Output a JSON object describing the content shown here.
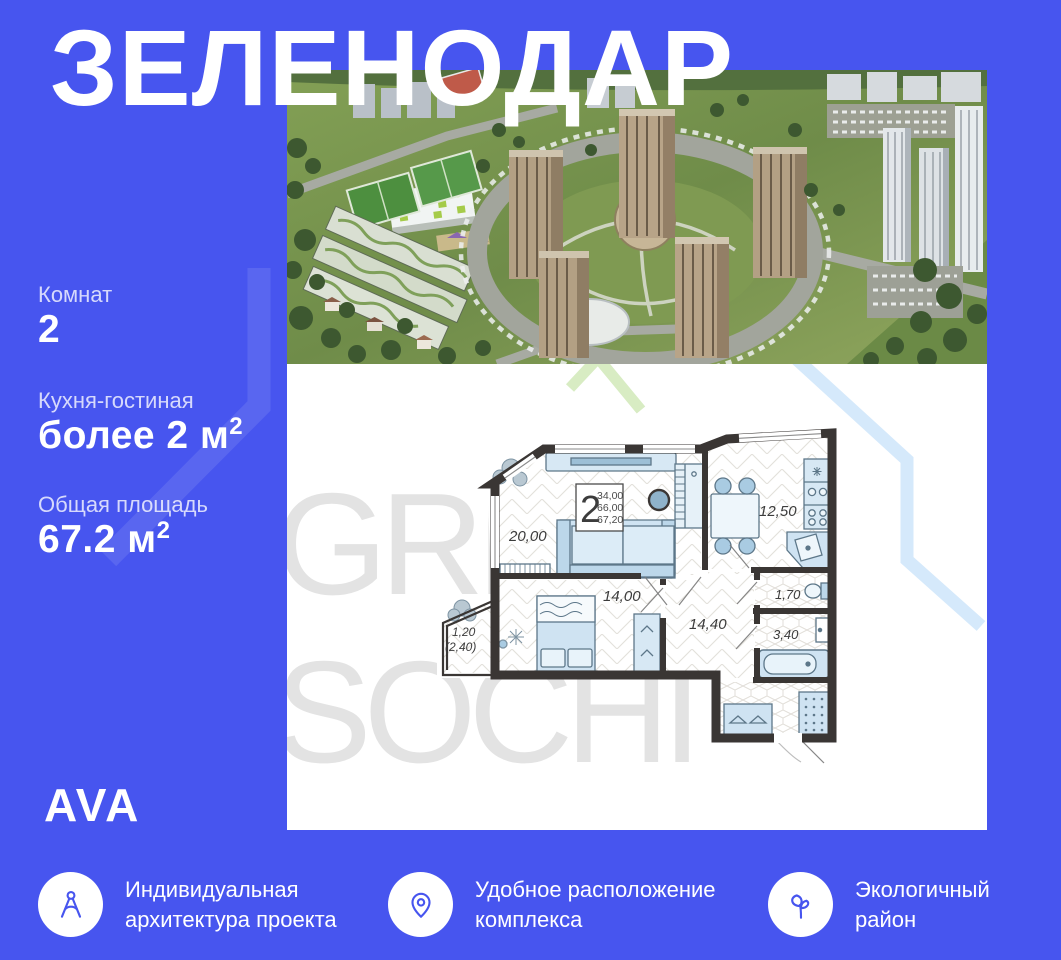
{
  "title": "ЗЕЛЕНОДАР",
  "brand": "AVA",
  "colors": {
    "background_blue": "#4755ef",
    "panel_white": "#ffffff",
    "wall_dark": "#3a3634",
    "furniture_blue": "#cfe3f2",
    "watermark_gray": "#e3e3e3",
    "decor_light_blue": "#d5e9fb",
    "decor_light_green": "#d8ecc3"
  },
  "stats": [
    {
      "label": "Комнат",
      "value": "2",
      "sup": ""
    },
    {
      "label": "Кухня-гостиная",
      "value": "более 2 м",
      "sup": "2"
    },
    {
      "label": "Общая площадь",
      "value": "67.2 м",
      "sup": "2"
    }
  ],
  "watermark": {
    "line1": "GREEN",
    "line2": "SOCHI"
  },
  "plan": {
    "stat_box": {
      "rooms_count": "2",
      "area1": "34,00",
      "area2": "66,00",
      "area3": "67,20"
    },
    "rooms": {
      "living": "20,00",
      "bedroom": "14,00",
      "hall": "14,40",
      "kitchen": "12,50",
      "wc": "1,70",
      "bath": "3,40",
      "balcony_line1": "1,20",
      "balcony_line2": "(2,40)"
    }
  },
  "features": [
    {
      "icon": "drafting-compass",
      "line1": "Индивидуальная",
      "line2": "архитектура проекта"
    },
    {
      "icon": "location-pin",
      "line1": "Удобное расположение",
      "line2": "комплекса"
    },
    {
      "icon": "sprout",
      "line1": "Экологичный",
      "line2": "район"
    }
  ]
}
